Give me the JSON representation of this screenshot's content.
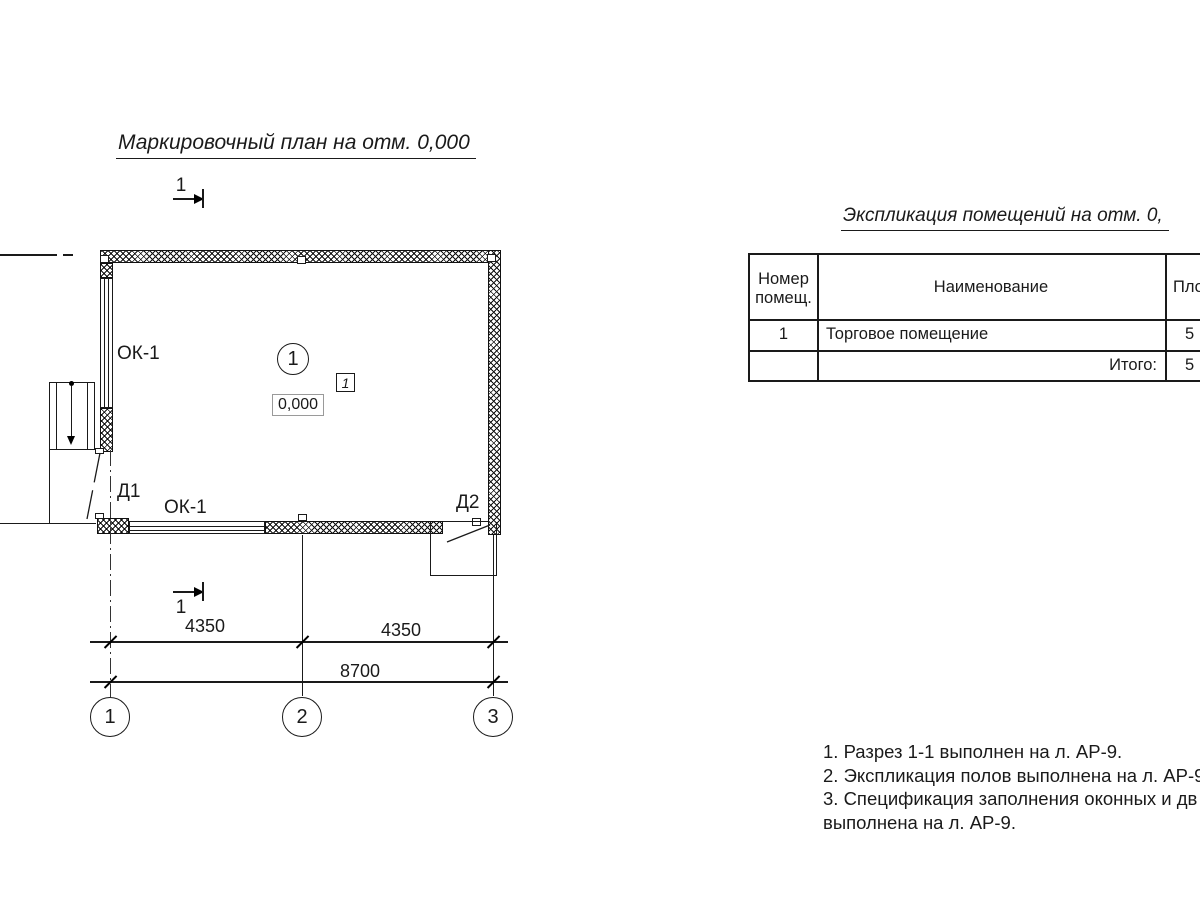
{
  "colors": {
    "ink": "#1a1a1a",
    "background": "#ffffff"
  },
  "plan": {
    "title": "Маркировочный план на отм. 0,000",
    "section_marks": {
      "top": "1",
      "bottom": "1"
    },
    "room_tag": "1",
    "floor_type_tag": "1",
    "elevation_mark": "0,000",
    "labels": {
      "window_left": "ОК-1",
      "window_bottom": "ОК-1",
      "door_1": "Д1",
      "door_2": "Д2"
    },
    "dimensions": {
      "left": "4350",
      "right": "4350",
      "total": "8700"
    },
    "axes": [
      "1",
      "2",
      "3"
    ]
  },
  "table": {
    "title": "Экспликация помещений на отм. 0,",
    "header": {
      "col1_line1": "Номер",
      "col1_line2": "помещ.",
      "col2": "Наименование",
      "col3": "Пло"
    },
    "rows": [
      {
        "number": "1",
        "name": "Торговое помещение",
        "area": "5"
      },
      {
        "number": "",
        "name": "Итого:",
        "area": "5"
      }
    ]
  },
  "notes": {
    "lines": [
      "1. Разрез 1-1 выполнен на л. АР-9.",
      "2. Экспликация полов выполнена на л. АР-9",
      "3. Спецификация заполнения оконных и дв",
      "выполнена  на л. АР-9."
    ]
  }
}
